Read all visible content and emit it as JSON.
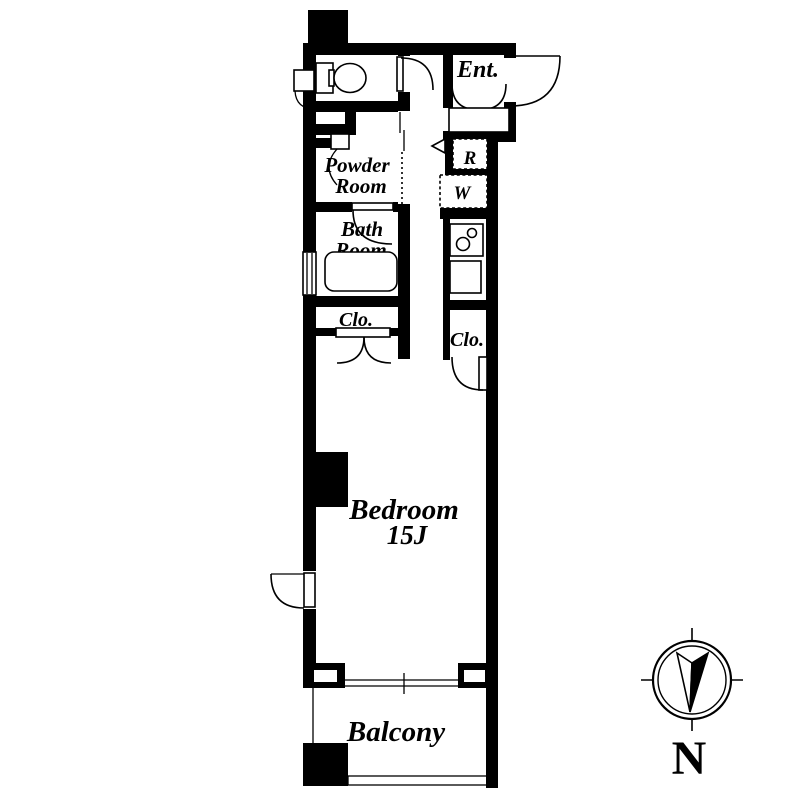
{
  "floorplan": {
    "labels": {
      "entrance": "Ent.",
      "powder_line1": "Powder",
      "powder_line2": "Room",
      "bath_line1": "Bath",
      "bath_line2": "Room",
      "closet_left": "Clo.",
      "closet_right": "Clo.",
      "fridge": "R",
      "washer": "W",
      "bedroom_name": "Bedroom",
      "bedroom_size": "15J",
      "balcony": "Balcony"
    },
    "compass": {
      "north": "N"
    },
    "colors": {
      "wall": "#000000",
      "background": "#ffffff"
    }
  }
}
